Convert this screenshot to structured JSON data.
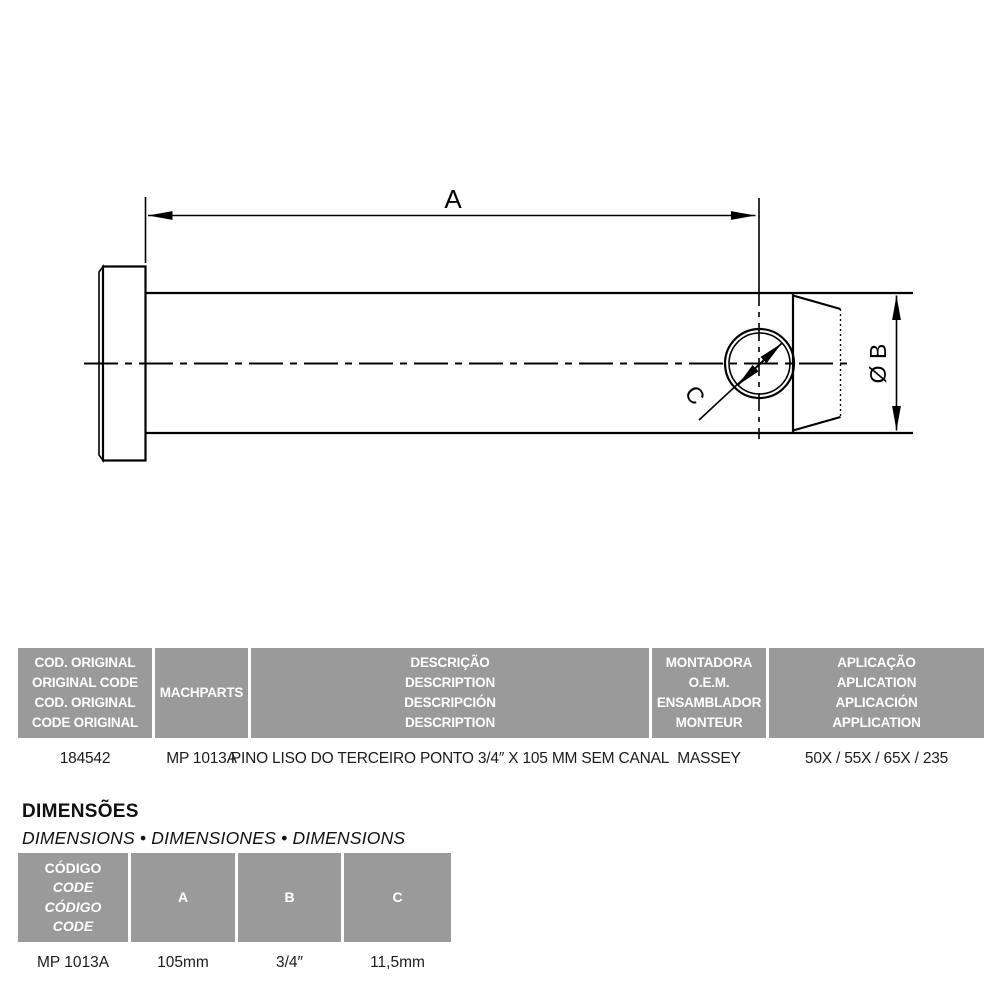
{
  "colors": {
    "background": "#ffffff",
    "table_header_bg": "#9a9a9a",
    "table_header_text": "#ffffff",
    "drawing_line": "#000000",
    "body_text": "#1c1c1c"
  },
  "drawing": {
    "label_a": "A",
    "label_b": "Ø B",
    "label_c": "C"
  },
  "main_table": {
    "headers": [
      {
        "lines": [
          "COD. ORIGINAL",
          "ORIGINAL CODE",
          "COD. ORIGINAL",
          "CODE ORIGINAL"
        ]
      },
      {
        "lines": [
          "MACHPARTS"
        ]
      },
      {
        "lines": [
          "DESCRIÇÃO",
          "DESCRIPTION",
          "DESCRIPCIÓN",
          "DESCRIPTION"
        ]
      },
      {
        "lines": [
          "MONTADORA",
          "O.E.M.",
          "ENSAMBLADOR",
          "MONTEUR"
        ]
      },
      {
        "lines": [
          "APLICAÇÃO",
          "APLICATION",
          "APLICACIÓN",
          "APPLICATION"
        ]
      }
    ],
    "row": [
      "184542",
      "MP 1013A",
      "PINO LISO DO TERCEIRO PONTO 3/4″ X 105 MM SEM CANAL",
      "MASSEY",
      "50X / 55X / 65X / 235"
    ]
  },
  "dimensions_section": {
    "title": "DIMENSÕES",
    "subtitle": "DIMENSIONS • DIMENSIONES • DIMENSIONS",
    "table": {
      "headers": [
        {
          "lines": [
            "CÓDIGO",
            "CODE",
            "CÓDIGO",
            "CODE"
          ]
        },
        {
          "label": "A"
        },
        {
          "label": "B"
        },
        {
          "label": "C"
        }
      ],
      "row": [
        "MP 1013A",
        "105mm",
        "3/4″",
        "11,5mm"
      ]
    }
  }
}
